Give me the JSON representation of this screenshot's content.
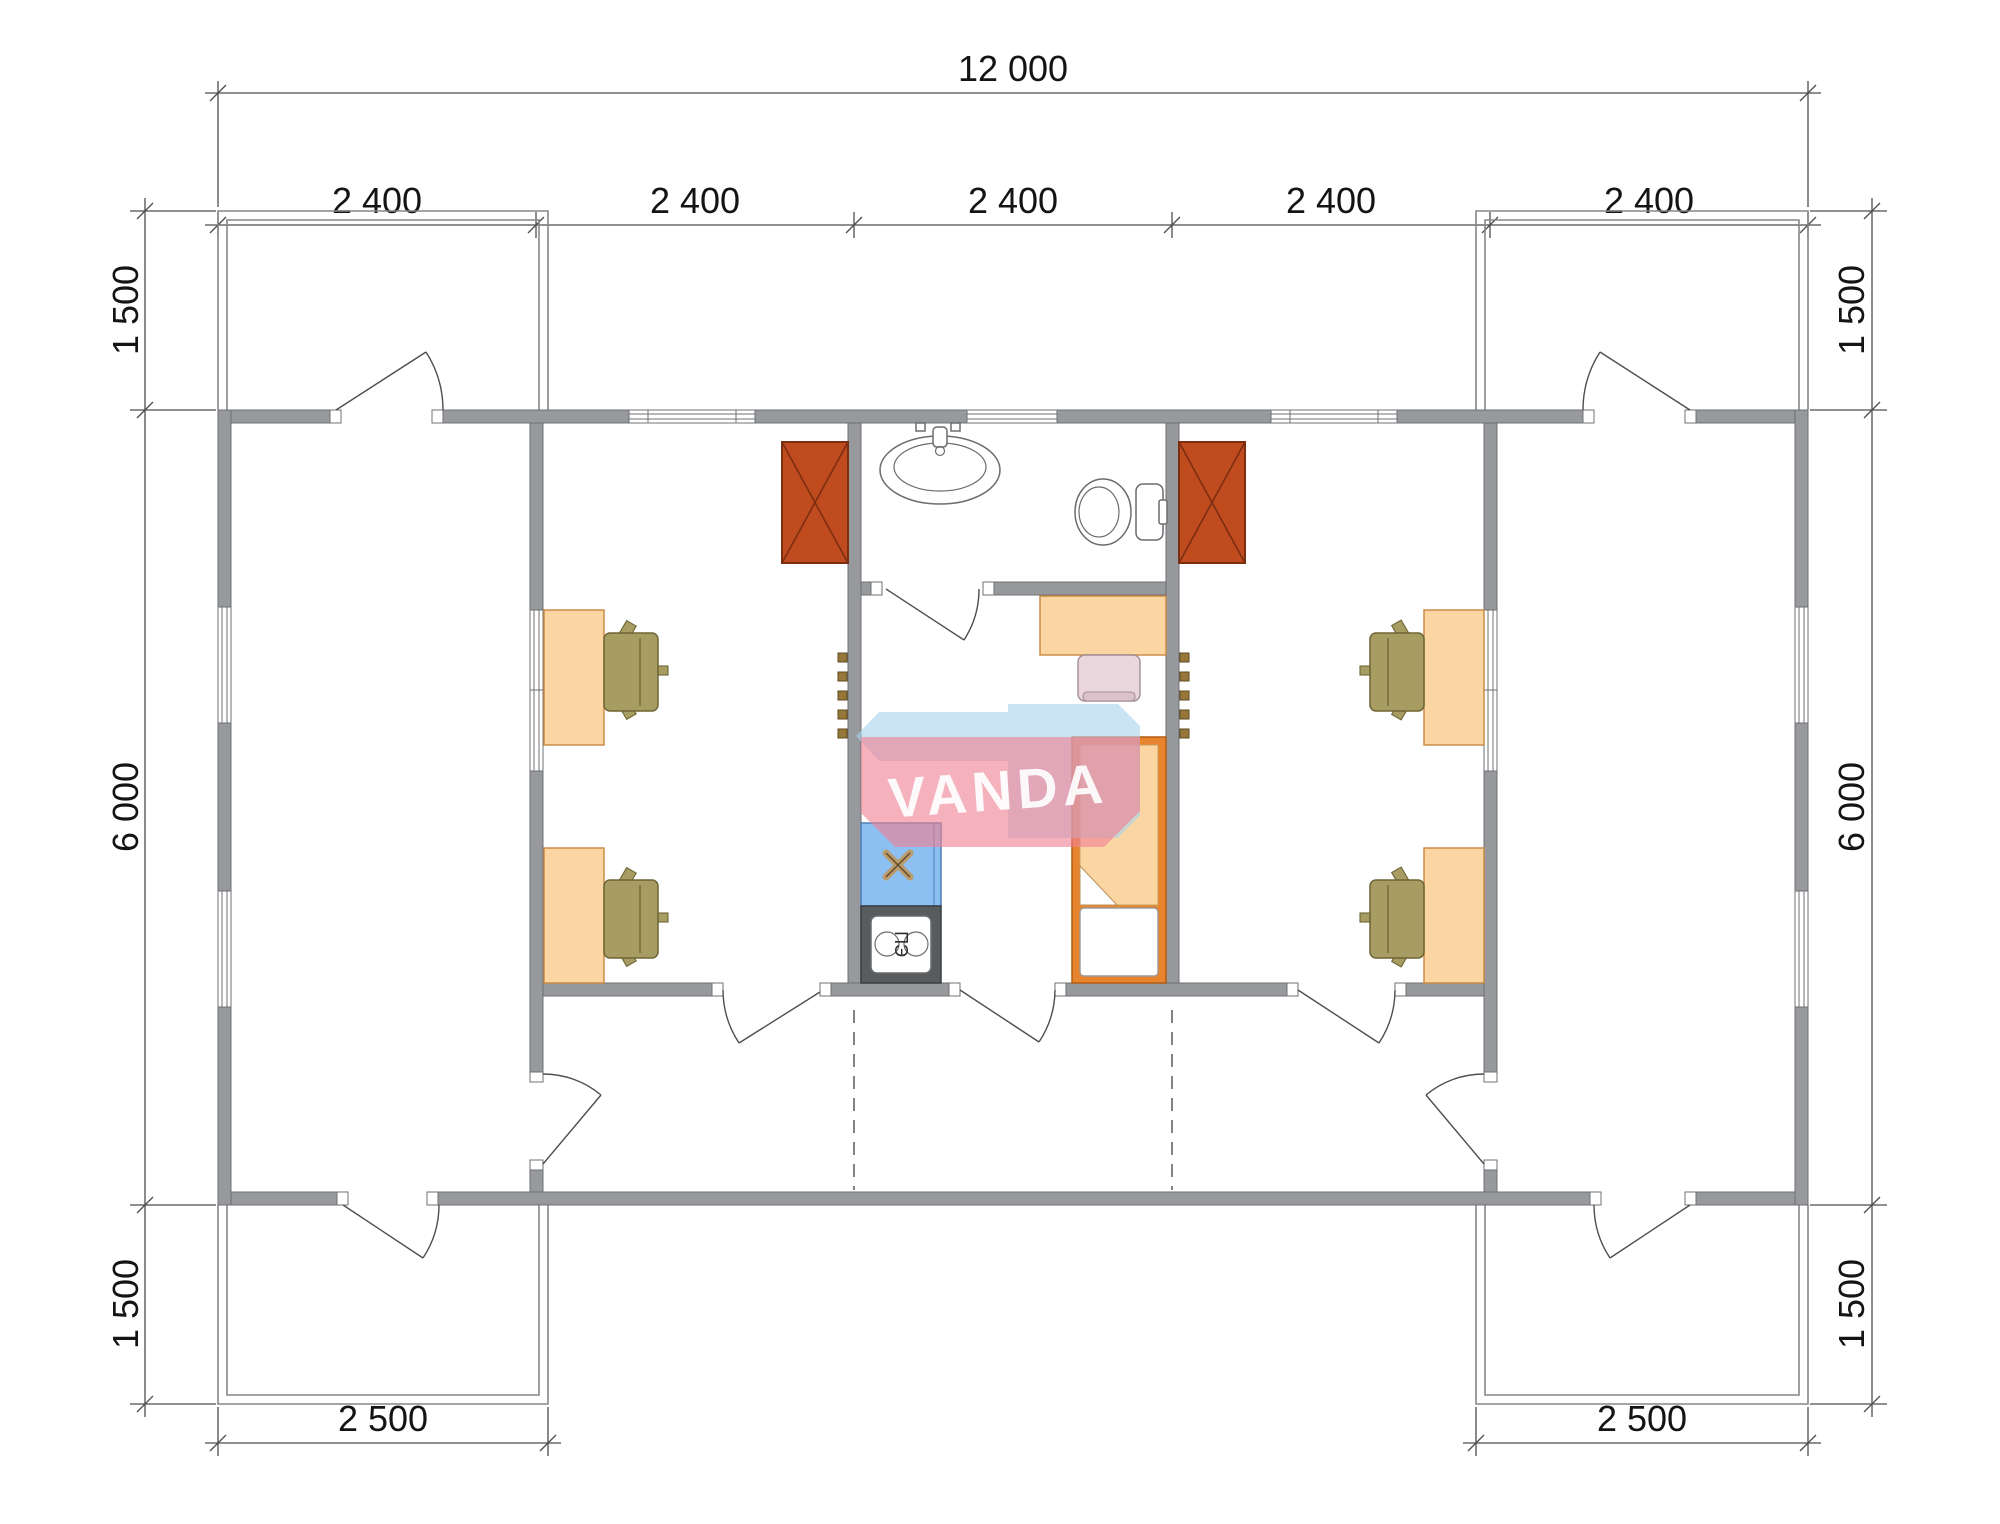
{
  "page": {
    "type": "architectural-floor-plan",
    "background": "#ffffff"
  },
  "watermark": {
    "text": "VANDA"
  },
  "kitchen": {
    "electric_stove_label": "ПЭ"
  },
  "dimensions": {
    "overall_width": "12 000",
    "modules": [
      "2 400",
      "2 400",
      "2 400",
      "2 400",
      "2 400"
    ],
    "left_top": "1 500",
    "left_middle": "6 000",
    "left_bottom": "1 500",
    "right_top": "1 500",
    "right_middle": "6 000",
    "right_bottom": "1 500",
    "bottom_left": "2 500",
    "bottom_right": "2 500"
  },
  "fixtures": [
    "wood-stove-left",
    "wood-stove-right",
    "bathroom-sink",
    "toilet",
    "kitchen-sink",
    "electric-stove",
    "bed",
    "office-desk-1",
    "office-desk-2",
    "office-desk-3",
    "office-desk-4",
    "bedroom-desk",
    "office-chair-1",
    "office-chair-2",
    "office-chair-3",
    "office-chair-4",
    "bedroom-chair",
    "coat-hooks-left",
    "coat-hooks-right"
  ],
  "colors": {
    "wall": "#97999c",
    "wall_outline": "#6e7073",
    "line": "#4e4e4e",
    "thin_wall": "#85878a",
    "dim_text": "#141414",
    "stove_red": "#bf4b1e",
    "stove_red_dark": "#7c2e11",
    "furniture_peach": "#fbd6a3",
    "furniture_outline": "#c9873f",
    "chair_olive": "#a79d62",
    "chair_olive_dark": "#6d6535",
    "bed_orange": "#e8832e",
    "bed_orange_dark": "#b35c12",
    "chair_pink": "#e9d7dd",
    "chair_pink_dark": "#a28e95",
    "sink_blue": "#8cc0f2",
    "sink_blue_dark": "#4c7fb5",
    "appliance_dark": "#595c5f",
    "appliance_dark_stroke": "#3c3e40",
    "hook_brown": "#97783a",
    "hook_brown_dark": "#5e4a1f",
    "fixture_line": "#6a6c6e",
    "watermark_red": "#ef8193",
    "watermark_blue": "#a9d3ec"
  }
}
